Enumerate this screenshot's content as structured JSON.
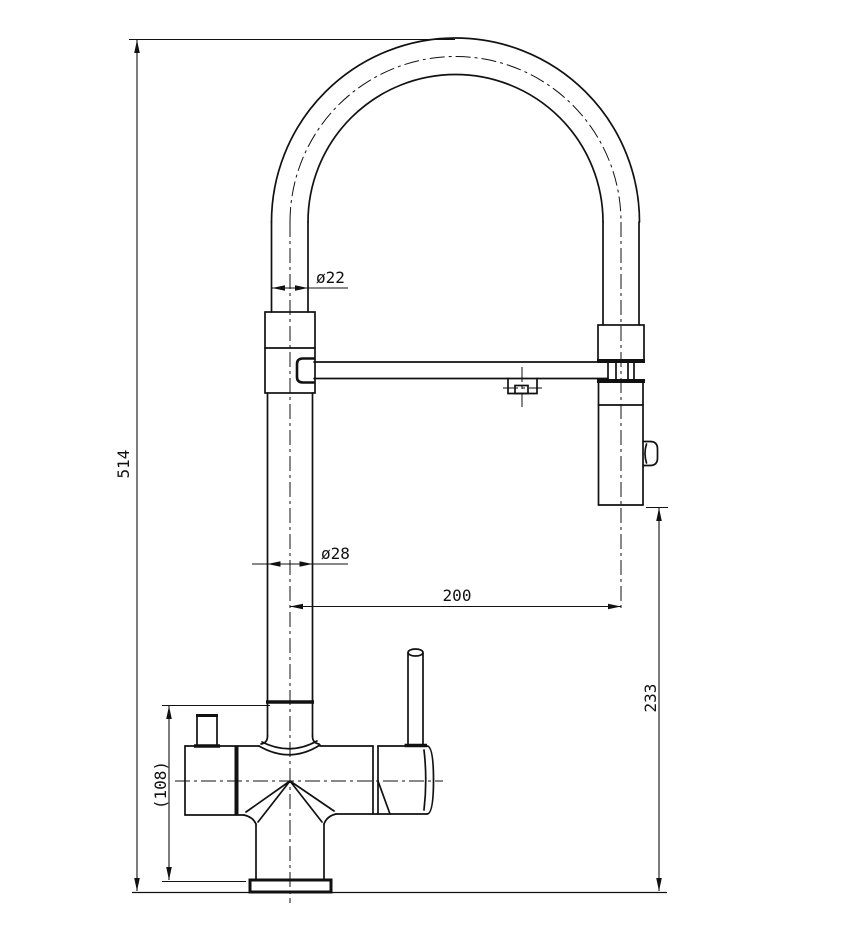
{
  "drawing": {
    "background": "#ffffff",
    "line_color": "#111111",
    "labels": {
      "total_height": "514",
      "hose_diameter": "ø22",
      "riser_diameter": "ø28",
      "spout_reach": "200",
      "spray_head_clearance": "233",
      "body_height": "(108)"
    }
  }
}
